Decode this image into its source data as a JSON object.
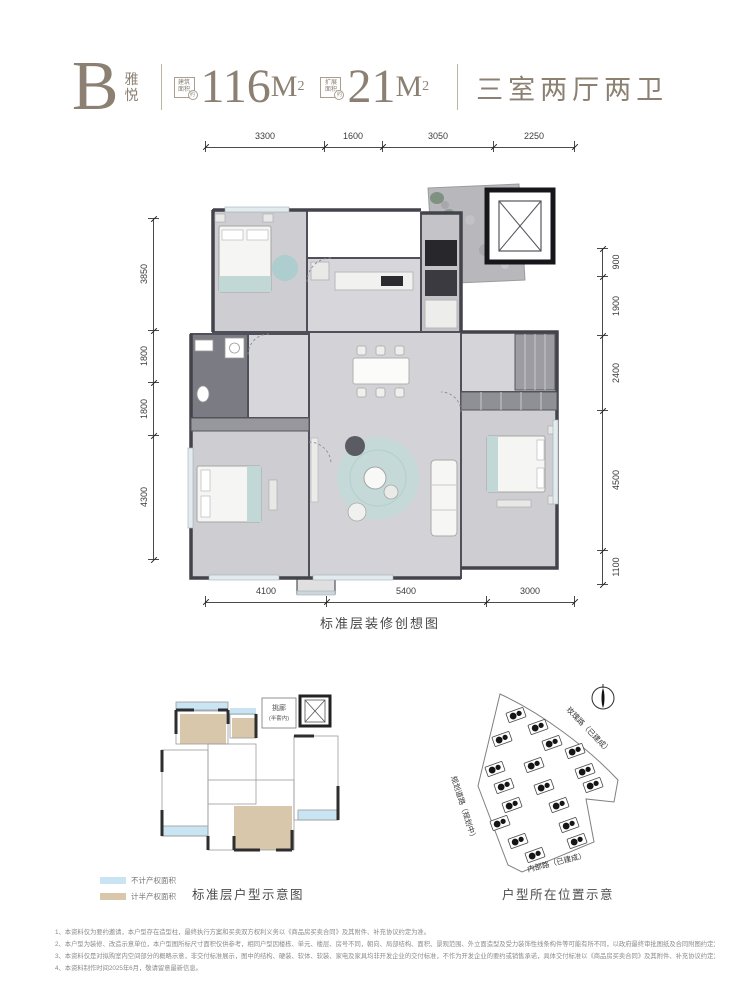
{
  "header": {
    "block_letter": "B",
    "block_name_top": "雅",
    "block_name_bottom": "悦",
    "areas": [
      {
        "tag_line1": "建筑",
        "tag_line2": "面积",
        "tag_suffix": "约",
        "value": "116",
        "unit": "M",
        "sup": "2"
      },
      {
        "tag_line1": "扩展",
        "tag_line2": "面积",
        "tag_suffix": "约",
        "value": "21",
        "unit": "M",
        "sup": "2"
      }
    ],
    "layout_summary": "三室两厅两卫"
  },
  "floor_plan": {
    "caption": "标准层装修创想图",
    "dims_top": [
      "3300",
      "1600",
      "3050",
      "2250"
    ],
    "dims_bottom": [
      "4100",
      "5400",
      "3000"
    ],
    "dims_left": [
      "3850",
      "1800",
      "1800",
      "4300"
    ],
    "dims_right": [
      "900",
      "1900",
      "2400",
      "4500",
      "1100"
    ]
  },
  "schematic": {
    "caption": "标准层户型示意图",
    "corridor_label": "挑廊",
    "corridor_sublabel": "(半套内)",
    "legend": [
      {
        "label": "不计产权面积",
        "color": "#c9e4f2"
      },
      {
        "label": "计半产权面积",
        "color": "#d9c7ab"
      }
    ]
  },
  "site_map": {
    "caption": "户型所在位置示意",
    "road_top": "玫瑰路（已建成）",
    "road_left": "规划道路（规划中）",
    "road_bottom": "内部路（已建成）"
  },
  "footer": {
    "notes": [
      "1、本资料仅为要约邀请，本户型存在造型柱，最终执行方案和买卖双方权利义务以《商品房买卖合同》及其附件、补充协议约定为准。",
      "2、本户型为装修、改造示意单位，本户型图所标尺寸面积仅供参考，相同户型因楼栋、单元、楼层、房号不同，朝向、局部结构、面积、景观范围、外立面造型及受力装饰性线条构件等可能有所不同，以政府最终审批图纸及合同附图约定为准。",
      "3、本资料仅是对拟购室内空间部分的概略示意，非交付标准展示，图中的结构、硬装、软体、软装、家电及家具均非开发企业的交付标准，不作为开发企业的要约或销售承诺，具体交付标准以《商品房买卖合同》及其附件、补充协议约定为准。",
      "4、本资料制作时间2025年6月，敬请留意最新信息。"
    ]
  }
}
